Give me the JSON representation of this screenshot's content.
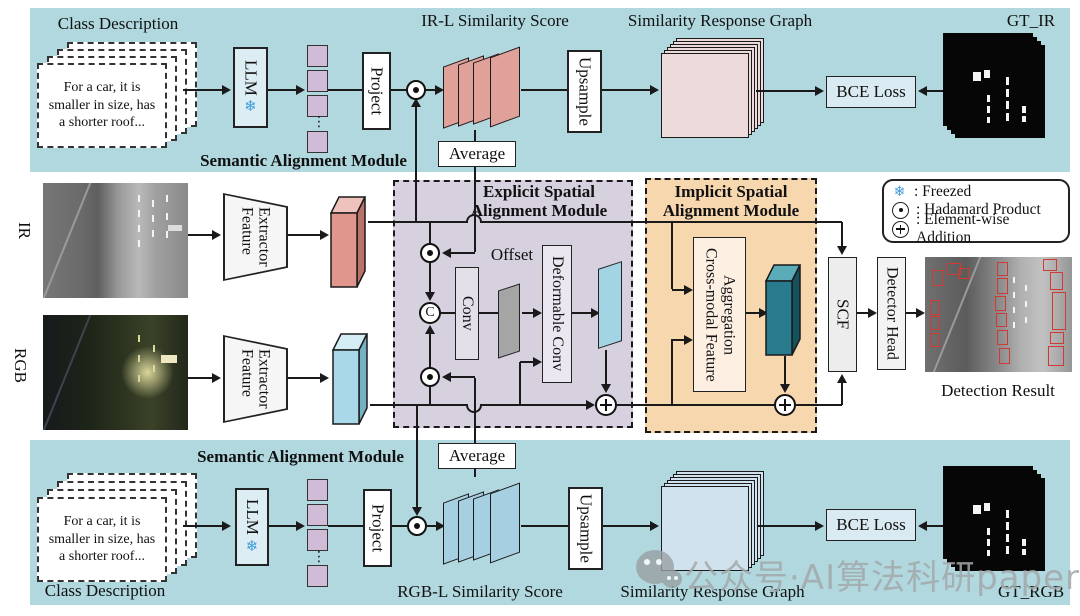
{
  "top": {
    "class_description": "Class Description",
    "card_text": "For a car, it is smaller in size, has a shorter roof...",
    "llm": "LLM",
    "project": "Project",
    "score_title": "IR-L Similarity Score",
    "average": "Average",
    "upsample": "Upsample",
    "graph_title": "Similarity Response Graph",
    "bce": "BCE Loss",
    "gt": "GT_IR",
    "module": "Semantic Alignment Module"
  },
  "bottom": {
    "class_description": "Class Description",
    "card_text": "For a car, it is smaller in size, has a shorter roof...",
    "llm": "LLM",
    "project": "Project",
    "score_title": "RGB-L Similarity Score",
    "average": "Average",
    "upsample": "Upsample",
    "graph_title": "Similarity Response Graph",
    "bce": "BCE Loss",
    "gt": "GT_RGB",
    "module": "Semantic Alignment Module"
  },
  "middle": {
    "ir": "IR",
    "rgb": "RGB",
    "feature_extractor_line1": "Feature",
    "feature_extractor_line2": "Extractor",
    "explicit_title": "Explicit Spatial Alignment Module",
    "implicit_title": "Implicit Spatial Alignment Module",
    "offset": "Offset",
    "conv": "Conv",
    "deformable": "Deformable Conv",
    "cross_modal_line1": "Cross-modal Feature",
    "cross_modal_line2": "Aggregation",
    "scf": "SCF",
    "detector": "Detector Head",
    "detection_result": "Detection Result",
    "concat": "C"
  },
  "legend": {
    "items": [
      {
        "icon": "snowflake-icon",
        "label": ": Freezed"
      },
      {
        "icon": "hadamard-icon",
        "label": ": Hadamard Product"
      },
      {
        "icon": "add-icon",
        "label": ": Element-wise Addition"
      }
    ]
  },
  "icons": {
    "snowflake": "❄",
    "ellipsis": "⋮"
  },
  "watermark": "公众号·AI算法科研paper",
  "colors": {
    "band": "#b0d8de",
    "explicit_bg": "#d6d0df",
    "implicit_bg": "#f7d7ae",
    "ir_feature": "#e0958d",
    "rgb_feature": "#a9d8e8",
    "fused_feature": "#277b8c",
    "text_embedding": "#d0bcd7",
    "ir_score": "#e1a19b",
    "rgb_score": "#a6cfe2",
    "ir_response": "#eddadb",
    "rgb_response": "#cfe2ed",
    "snowflake_blue": "#3d9bd9"
  }
}
